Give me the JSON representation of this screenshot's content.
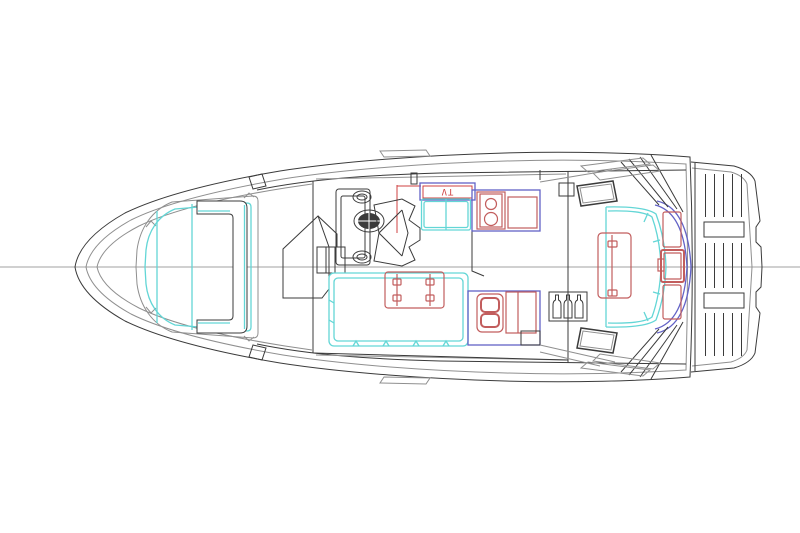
{
  "drawing": {
    "labels": {
      "tv": "TV"
    },
    "colors": {
      "line": "#3b3b3b",
      "line_light": "#8f8f8f",
      "centerline": "#a0a0a0",
      "upholstery_cyan": "#63d6d6",
      "furniture_red": "#c25d5d",
      "accent_red": "#cf4040",
      "trim_blue": "#6262c6",
      "background": "#ffffff"
    }
  }
}
